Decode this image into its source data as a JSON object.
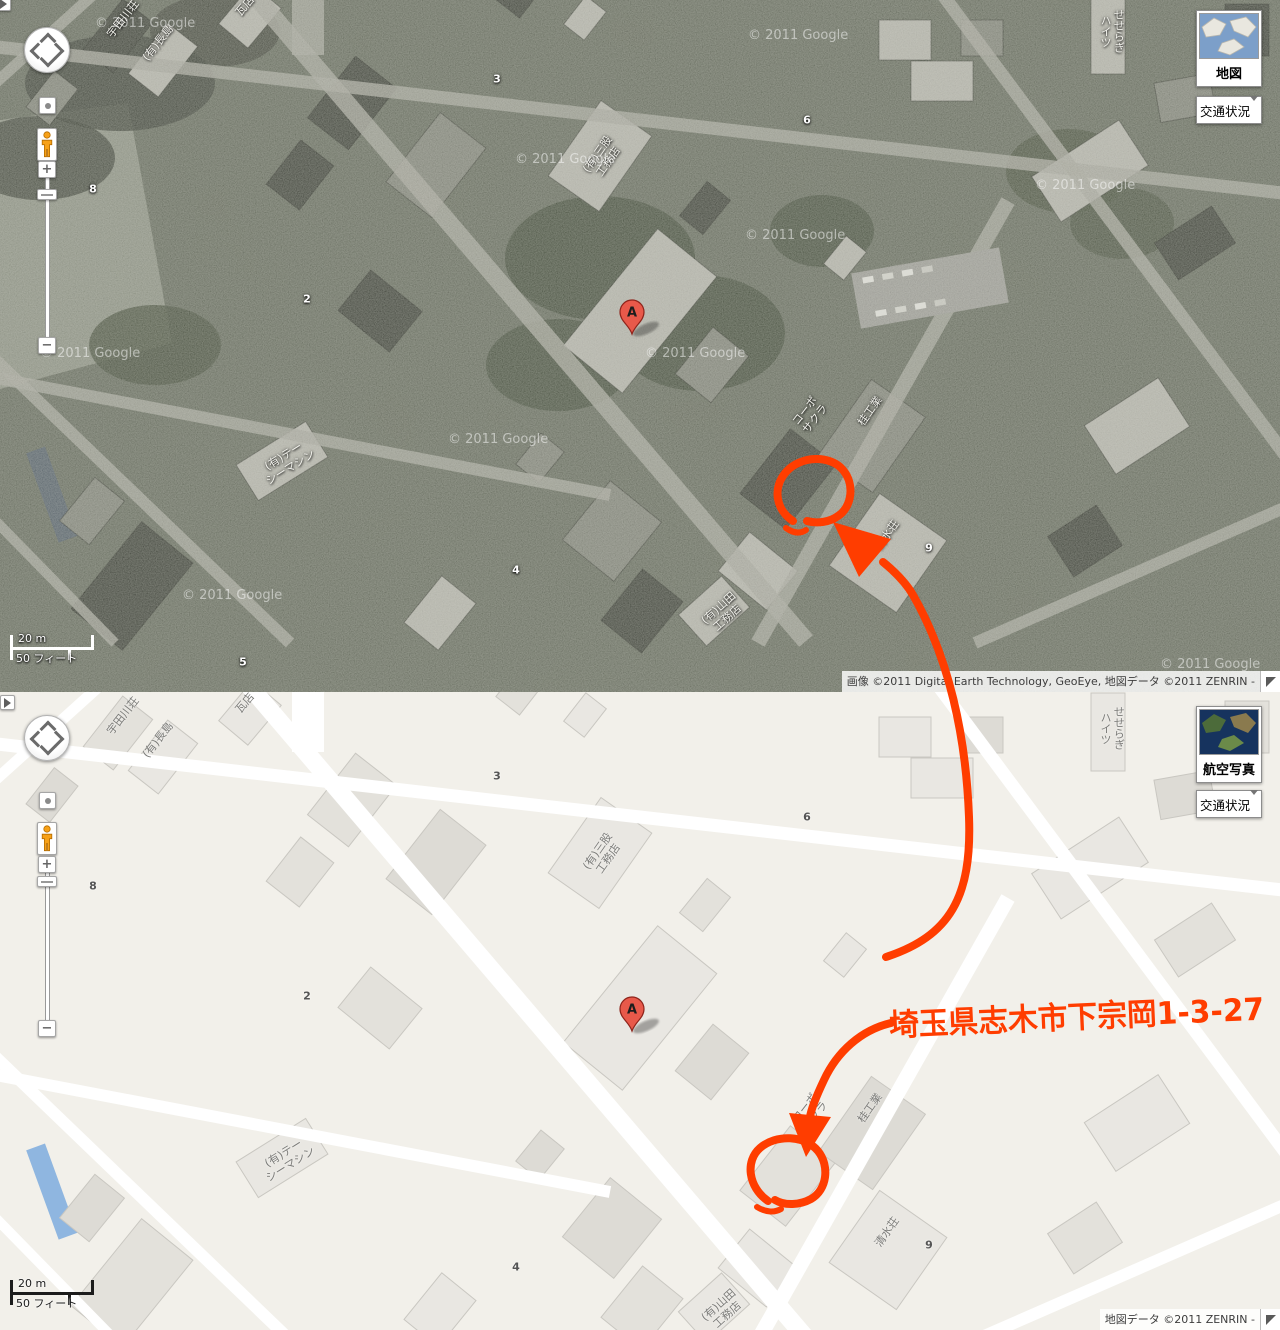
{
  "annotation": {
    "address": "埼玉県志木市下宗岡1-3-27"
  },
  "marker": {
    "label": "A"
  },
  "colors": {
    "annotation": "#ff3d00",
    "pin_red": "#e8594a",
    "satellite_base": "#565a4e",
    "map_land": "#f2f0ea"
  },
  "controls": {
    "map_type_map": "地図",
    "map_type_satellite": "航空写真",
    "traffic": "交通状況",
    "zoom_in": "+",
    "zoom_out": "−"
  },
  "scale": {
    "meters": "20 m",
    "feet": "50 フィート"
  },
  "copyright": {
    "aerial": "画像 ©2011 Digital Earth Technology, GeoEye, 地図データ ©2011 ZENRIN -",
    "map": "地図データ ©2011 ZENRIN -"
  },
  "watermark": {
    "text": "© 2011 Google",
    "positions": [
      {
        "x": 95,
        "y": 16
      },
      {
        "x": 748,
        "y": 28
      },
      {
        "x": 515,
        "y": 152
      },
      {
        "x": 1035,
        "y": 178
      },
      {
        "x": 745,
        "y": 228
      },
      {
        "x": 40,
        "y": 346
      },
      {
        "x": 645,
        "y": 346
      },
      {
        "x": 448,
        "y": 432
      },
      {
        "x": 182,
        "y": 588
      },
      {
        "x": 1160,
        "y": 657
      }
    ]
  },
  "places": [
    {
      "text": "宇田川荘",
      "x": 123,
      "y": 716,
      "rot": -52
    },
    {
      "text": "(有)長島",
      "x": 158,
      "y": 740,
      "rot": -52
    },
    {
      "text": "瓦店",
      "x": 245,
      "y": 703,
      "rot": -50
    },
    {
      "text": "せせらぎ\nハイツ",
      "x": 1112,
      "y": 728,
      "rot": 0,
      "vertical": true
    },
    {
      "text": "(有)三股\n工務店",
      "x": 603,
      "y": 855,
      "rot": -55
    },
    {
      "text": "コーポ\nサクラ",
      "x": 810,
      "y": 1112,
      "rot": -52
    },
    {
      "text": "桂工業",
      "x": 870,
      "y": 1108,
      "rot": -55
    },
    {
      "text": "清水荘",
      "x": 887,
      "y": 1232,
      "rot": -55
    },
    {
      "text": "(有)テー\nシーマシン",
      "x": 287,
      "y": 1159,
      "rot": -32
    },
    {
      "text": "(有)山田\n工務店",
      "x": 723,
      "y": 1310,
      "rot": -42
    }
  ],
  "street_numbers": [
    {
      "text": "3",
      "x": 497,
      "y": 776
    },
    {
      "text": "6",
      "x": 807,
      "y": 817
    },
    {
      "text": "8",
      "x": 93,
      "y": 886
    },
    {
      "text": "2",
      "x": 307,
      "y": 996
    },
    {
      "text": "4",
      "x": 516,
      "y": 1267
    },
    {
      "text": "9",
      "x": 929,
      "y": 1245
    },
    {
      "text": "5",
      "x": 243,
      "y": 1359
    }
  ]
}
